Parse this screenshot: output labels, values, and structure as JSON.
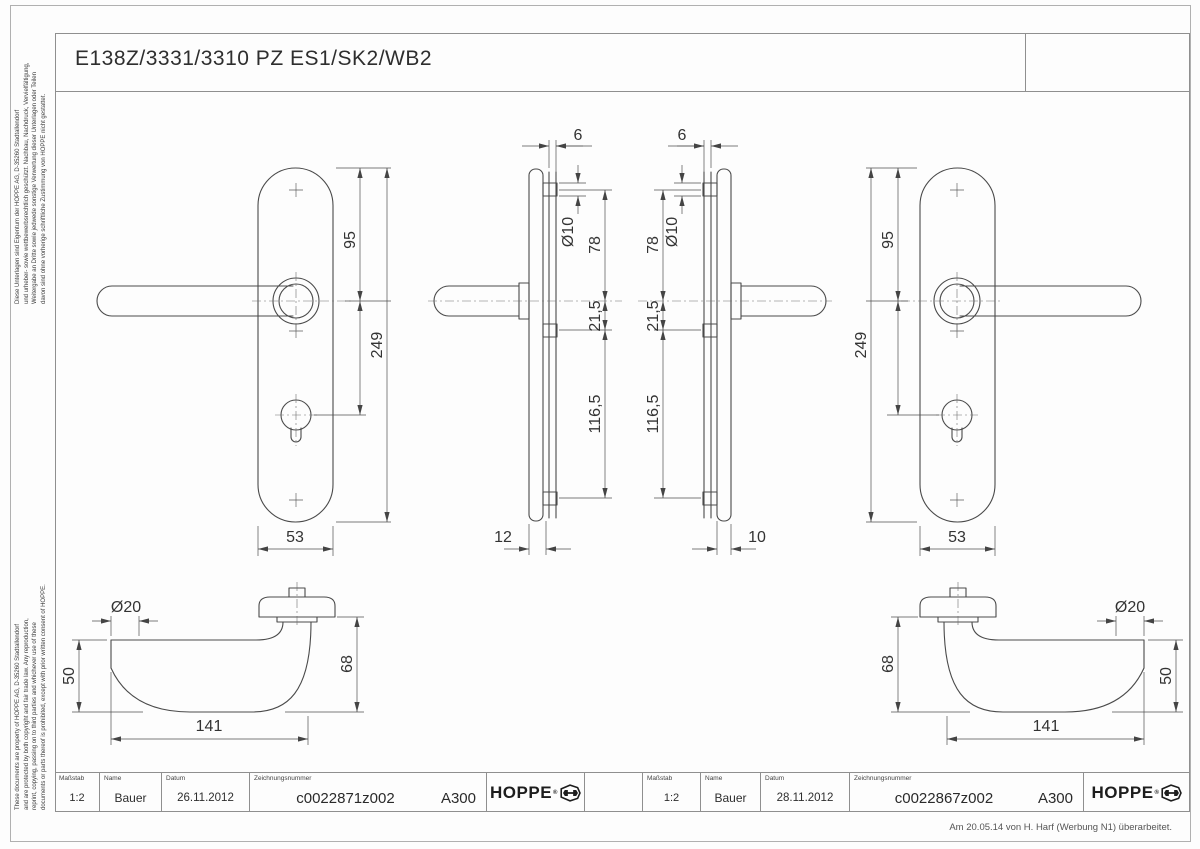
{
  "page": {
    "title": "E138Z/3331/3310 PZ ES1/SK2/WB2",
    "footnote": "Am 20.05.14 von H. Harf (Werbung N1) überarbeitet.",
    "legal_de": {
      "line1": "Diese Unterlagen sind Eigentum der HOPPE AG, D-35260 Stadtallendorf",
      "line2": "und urheber- sowie wettbewerbsrechtlich geschützt. Nachbau, Nachdruck, Vervielfältigung,",
      "line3": "Weitergabe an Dritte sowie jedwede sonstige Verwertung dieser Unterlagen oder Teilen",
      "line4": "davon sind ohne vorherige schriftliche Zustimmung von HOPPE nicht gestattet."
    },
    "legal_en": {
      "line1": "These documents are property of HOPPE AG, D-35260 Stadtallendorf",
      "line2": "and are protected by both copyright and fair trade law. Any reproduction,",
      "line3": "reprint, copying, passing on to third parties and whichever use of these",
      "line4": "documents or parts thereof is prohibited, except with prior written consent of HOPPE."
    }
  },
  "dims": {
    "front_left": {
      "to_handle": "95",
      "total": "249",
      "width": "53"
    },
    "side_left": {
      "stem": "6",
      "hole": "Ø10",
      "top_to_handle": "78",
      "handle_to_screw": "21,5",
      "screw_span": "116,5",
      "depth": "12"
    },
    "side_right": {
      "stem": "6",
      "hole": "Ø10",
      "top_to_handle": "78",
      "handle_to_screw": "21,5",
      "screw_span": "116,5",
      "depth": "10"
    },
    "front_right": {
      "to_handle": "95",
      "total": "249",
      "width": "53"
    },
    "lever_left": {
      "dia": "Ø20",
      "end_height": "50",
      "neck_height": "68",
      "length": "141"
    },
    "lever_right": {
      "dia": "Ø20",
      "end_height": "50",
      "neck_height": "68",
      "length": "141"
    }
  },
  "title_block": {
    "labels": {
      "scale": "Maßstab",
      "name": "Name",
      "date": "Datum",
      "number": "Zeichnungsnummer"
    },
    "left": {
      "scale": "1:2",
      "name": "Bauer",
      "date": "26.11.2012",
      "number": "c0022871z002",
      "code": "A300",
      "brand": "HOPPE",
      "brand_mark": "®"
    },
    "right": {
      "scale": "1:2",
      "name": "Bauer",
      "date": "28.11.2012",
      "number": "c0022867z002",
      "code": "A300",
      "brand": "HOPPE",
      "brand_mark": "®"
    }
  }
}
